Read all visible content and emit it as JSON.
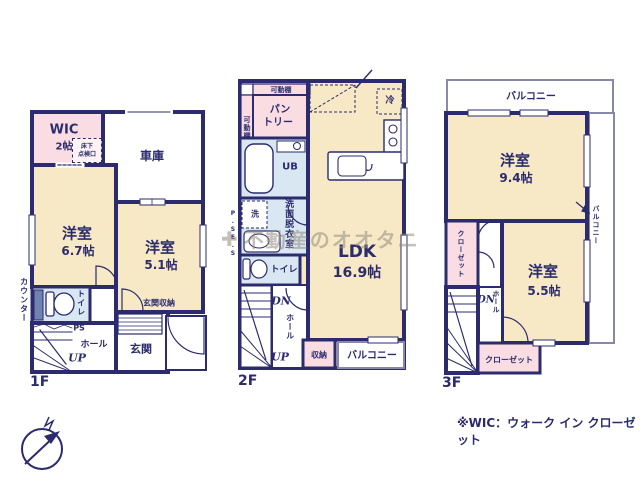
{
  "colors": {
    "wall": "#2b2b6e",
    "room_cream": "#f7e9c5",
    "room_pink": "#fadde2",
    "room_blue": "#d9e7f2",
    "balcony_line": "#8888aa",
    "watermark": "#948c80"
  },
  "floor1": {
    "name": "1F",
    "wic": "WIC",
    "wic_size": "2帖",
    "hatch1": "床下",
    "hatch2": "点検口",
    "garage": "車庫",
    "room_a": "洋室",
    "room_a_size": "6.7帖",
    "room_b": "洋室",
    "room_b_size": "5.1帖",
    "counter": "カウンター",
    "toilet": "トイレ",
    "ps": "PS",
    "hall": "ホール",
    "up": "UP",
    "entrance": "玄関",
    "entrance_storage": "玄関収納"
  },
  "floor2": {
    "name": "2F",
    "shelf_top": "可動棚",
    "shelf_side": "可動棚",
    "pantry1": "パン",
    "pantry2": "トリー",
    "fridge": "冷",
    "ub": "UB",
    "washer": "洗",
    "washroom": "洗面脱衣室",
    "toilet": "トイレ",
    "ps": "P.S",
    "es": "E.S",
    "ldk": "LDK",
    "ldk_size": "16.9帖",
    "dn": "DN",
    "hall": "ホール",
    "up": "UP",
    "storage": "収納",
    "balcony": "バルコニー"
  },
  "floor3": {
    "name": "3F",
    "balcony_top": "バルコニー",
    "room_a": "洋室",
    "room_a_size": "9.4帖",
    "room_b": "洋室",
    "room_b_size": "5.5帖",
    "closet_left": "クローゼット",
    "closet_bottom": "クローゼット",
    "balcony_right": "バルコニー",
    "dn": "DN",
    "hall": "ホール"
  },
  "annotations": {
    "watermark_logo": "✚",
    "watermark_text": "不動産のオオタニ",
    "wic_note": "※WIC：ウォーク イン クローゼット"
  }
}
